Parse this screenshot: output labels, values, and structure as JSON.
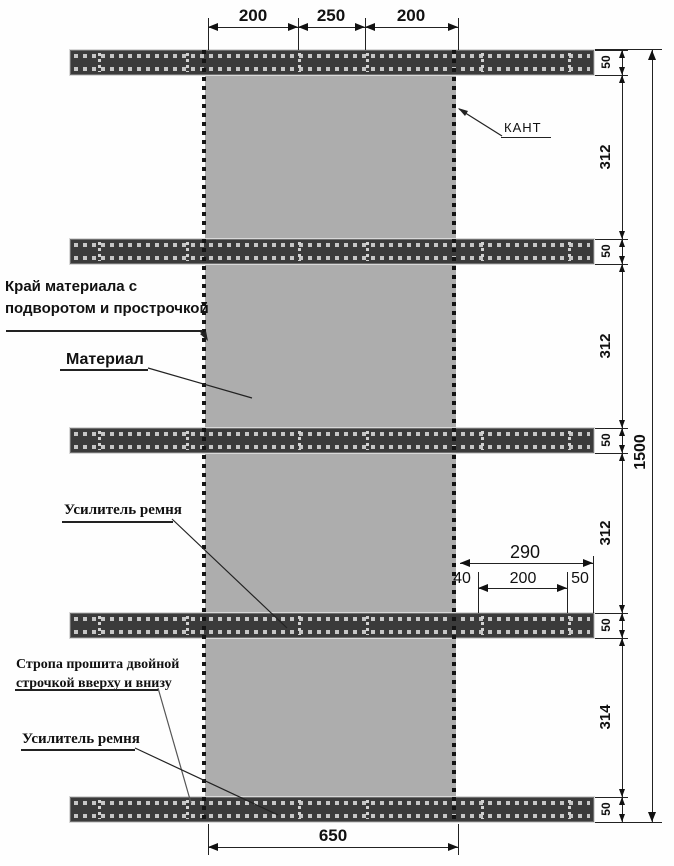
{
  "labels": {
    "kant": "КАНТ",
    "edge_line1": "Край материала с",
    "edge_line2": "подворотом и прострочкой",
    "material": "Материал",
    "belt_reinforcement_1": "Усилитель ремня",
    "strap_sewn_line1": "Стропа прошита двойной",
    "strap_sewn_line2": "строчкой вверху и внизу",
    "belt_reinforcement_2": "Усилитель ремня"
  },
  "dimensions": {
    "top": [
      "200",
      "250",
      "200"
    ],
    "right_chain": [
      "50",
      "312",
      "50",
      "312",
      "50",
      "312",
      "50",
      "314",
      "50"
    ],
    "overall_height": "1500",
    "material_width_bottom": "650",
    "mid_group": {
      "total": "290",
      "parts": [
        "40",
        "200",
        "50"
      ]
    }
  },
  "colors": {
    "strap": "#3b3b3b",
    "material": "#adadad",
    "line": "#1a1a1a",
    "background": "#ffffff"
  }
}
